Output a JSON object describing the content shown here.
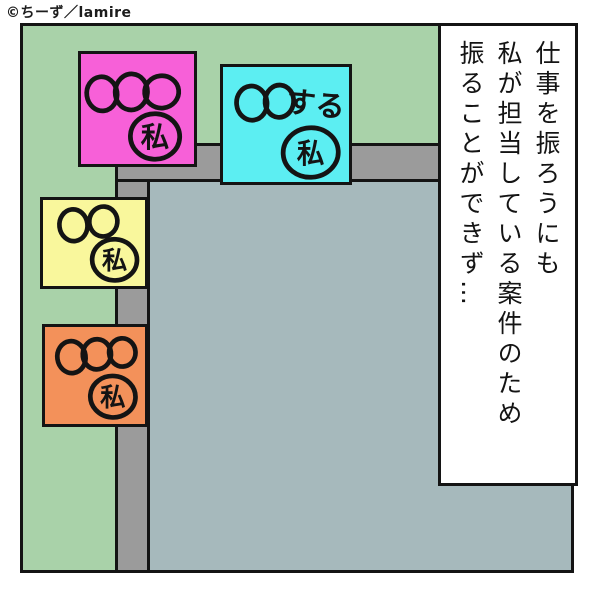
{
  "credit": {
    "text": "©ちーず／lamire"
  },
  "panel": {
    "background_color": "#a9d2a9",
    "outline_color": "#141414",
    "monitor": {
      "frame_color": "#9b9b9b",
      "screen_color": "#a6b9bc"
    }
  },
  "speech_box": {
    "background_color": "#ffffff",
    "lines": [
      "仕事を振ろうにも",
      "私が担当している案件のため",
      "振ることができず…"
    ]
  },
  "sticky_notes": [
    {
      "name": "pink-note",
      "color": "#f760d8",
      "doodle": "〇〇〇",
      "owner_label": "私"
    },
    {
      "name": "cyan-note",
      "color": "#5ceef2",
      "doodle": "〇〇",
      "action_text": "する",
      "owner_label": "私"
    },
    {
      "name": "yellow-note",
      "color": "#f9f79c",
      "doodle": "〇〇",
      "owner_label": "私"
    },
    {
      "name": "orange-note",
      "color": "#f3915a",
      "doodle": "〇〇〇",
      "owner_label": "私"
    }
  ]
}
